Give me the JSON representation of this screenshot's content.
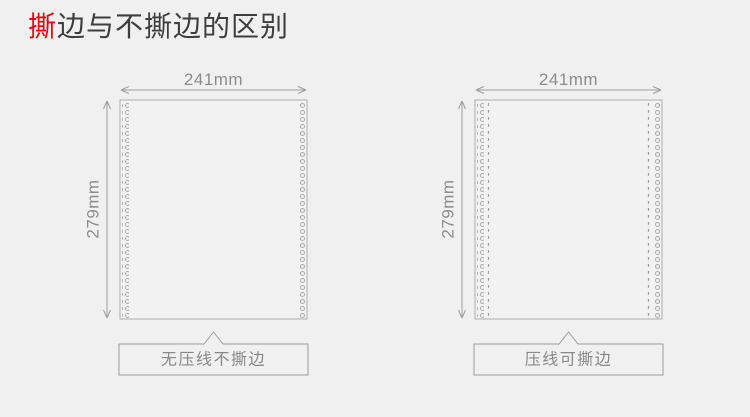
{
  "title": {
    "highlight": "撕",
    "rest": "边与不撕边的区别"
  },
  "colors": {
    "background": "#f0f0f0",
    "title_text": "#3e3e3e",
    "title_highlight": "#e60012",
    "diagram_lines": "#9d9d9d",
    "dimension_text": "#8c8c8c",
    "caption_text": "#888888",
    "paper_fill": "#f2f2f2",
    "paper_border": "#aeaeae",
    "hole_stroke": "#ababab"
  },
  "diagrams": [
    {
      "id": "no-tear-edge",
      "width_label": "241mm",
      "height_label": "279mm",
      "caption": "无压线不撕边",
      "crease_line": false
    },
    {
      "id": "tear-edge",
      "width_label": "241mm",
      "height_label": "279mm",
      "caption": "压线可撕边",
      "crease_line": true
    }
  ]
}
